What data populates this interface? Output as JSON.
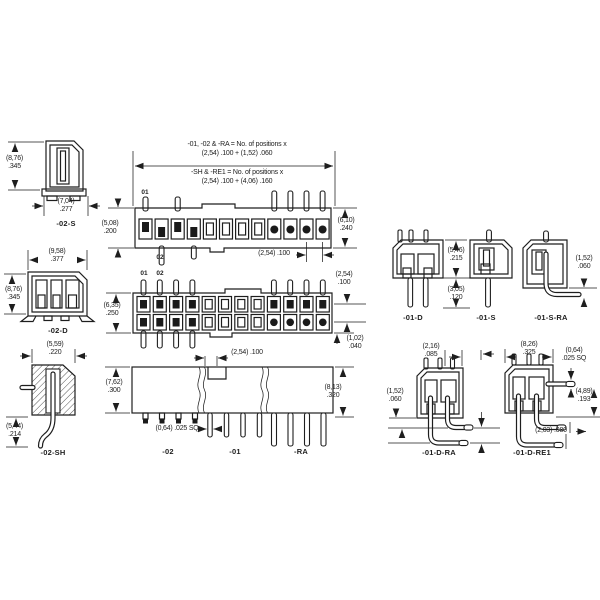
{
  "drawing": {
    "notes": {
      "line1": "-01, -02 & -RA = No. of positions x",
      "line2": "(2,54) .100 + (1,52) .060",
      "line3": "-SH & -RE1 = No. of positions x",
      "line4": "(2,54) .100 + (4,06) .160"
    },
    "pin_labels": {
      "p1": "01",
      "p2": "02"
    },
    "views": {
      "s2": {
        "label": "-02-S",
        "height_mm": "(8,76)",
        "height_in": ".345",
        "width_mm": "(7,04)",
        "width_in": ".277"
      },
      "d2": {
        "label": "-02-D",
        "width_mm": "(9,58)",
        "width_in": ".377",
        "height_mm": "(8,76)",
        "height_in": ".345"
      },
      "sh2": {
        "label": "-02-SH",
        "width_mm": "(5,59)",
        "width_in": ".220",
        "height_mm": "(5,44)",
        "height_in": ".214"
      },
      "single_row": {
        "left_mm": "(5,08)",
        "left_in": ".200",
        "right_mm": "(6,10)",
        "right_in": ".240",
        "pitch": "(2,54) .100"
      },
      "double_row": {
        "left_mm": "(6,35)",
        "left_in": ".250",
        "row_mm": "(2,54)",
        "row_in": ".100",
        "tail_mm": "(1,02)",
        "tail_in": ".040"
      },
      "side": {
        "left_mm": "(7,62)",
        "left_in": ".300",
        "right_mm": "(8,13)",
        "right_in": ".320",
        "pitch": "(2,54) .100",
        "sq": "(0,64) .025 SQ",
        "label_02": "-02",
        "label_01": "-01",
        "label_ra": "-RA"
      },
      "d1": {
        "label": "-01-D"
      },
      "s1": {
        "label": "-01-S"
      },
      "mid": {
        "dim1_mm": "(5,46)",
        "dim1_in": ".215",
        "dim2_mm": "(3,05)",
        "dim2_in": ".120"
      },
      "sra1": {
        "label": "-01-S-RA",
        "drop_mm": "(1,52)",
        "drop_in": ".060"
      },
      "dra1": {
        "label": "-01-D-RA",
        "top_mm": "(2,16)",
        "top_in": ".085",
        "left_mm": "(1,52)",
        "left_in": ".060"
      },
      "gap": {
        "mm": "(2,54)",
        "in": ".100"
      },
      "dre1": {
        "label": "-01-D-RE1",
        "top_mm": "(8,26)",
        "top_in": ".325",
        "sq_mm": "(0,64)",
        "sq_in": ".025 SQ",
        "right_mm": "(4,89)",
        "right_in": ".193",
        "bottom": "(2,03) .080"
      }
    }
  }
}
